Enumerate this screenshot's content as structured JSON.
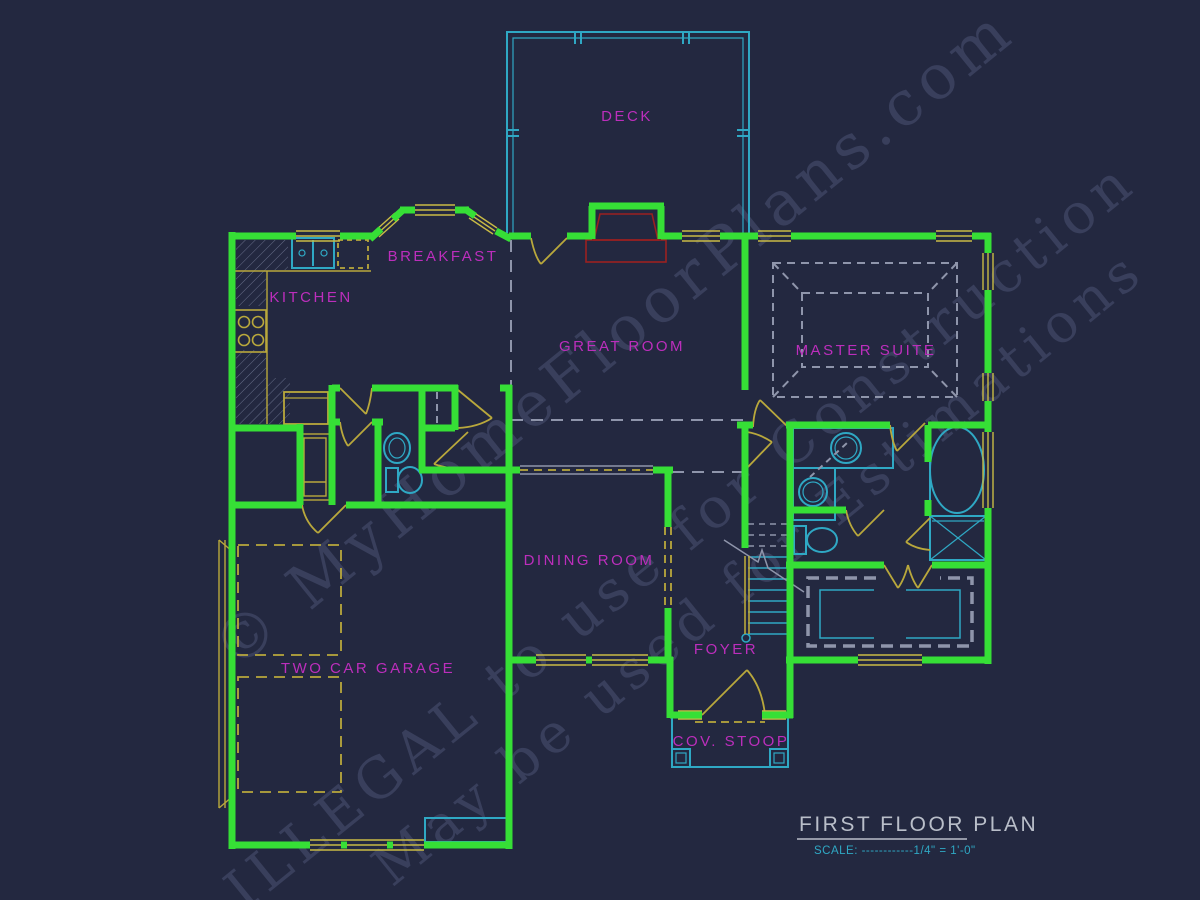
{
  "plan": {
    "rooms": [
      {
        "id": "deck",
        "label": "DECK"
      },
      {
        "id": "breakfast",
        "label": "BREAKFAST"
      },
      {
        "id": "kitchen",
        "label": "KITCHEN"
      },
      {
        "id": "great-room",
        "label": "GREAT ROOM"
      },
      {
        "id": "master-suite",
        "label": "MASTER SUITE"
      },
      {
        "id": "dining-room",
        "label": "DINING ROOM"
      },
      {
        "id": "foyer",
        "label": "FOYER"
      },
      {
        "id": "two-car-garage",
        "label": "TWO CAR GARAGE"
      },
      {
        "id": "cov-stoop",
        "label": "COV. STOOP"
      }
    ],
    "title_block": {
      "title": "FIRST FLOOR PLAN",
      "scale": "SCALE: ------------1/4\" = 1'-0\""
    },
    "watermark": {
      "line1": "© MyHomeFloorPlans.com",
      "line2": "ILLEGAL to use for Construction",
      "line3": "May be used for Estimations"
    },
    "colors": {
      "background": "#232840",
      "walls": "#36df36",
      "fixtures": "#2fa8c4",
      "doors_windows": "#b9a83c",
      "window_glass": "#c9bb45",
      "labels": "#bc2ebc",
      "fireplace": "#9b2020",
      "ceiling_dashed": "#8f95ab",
      "title": "#b9bec9"
    }
  }
}
